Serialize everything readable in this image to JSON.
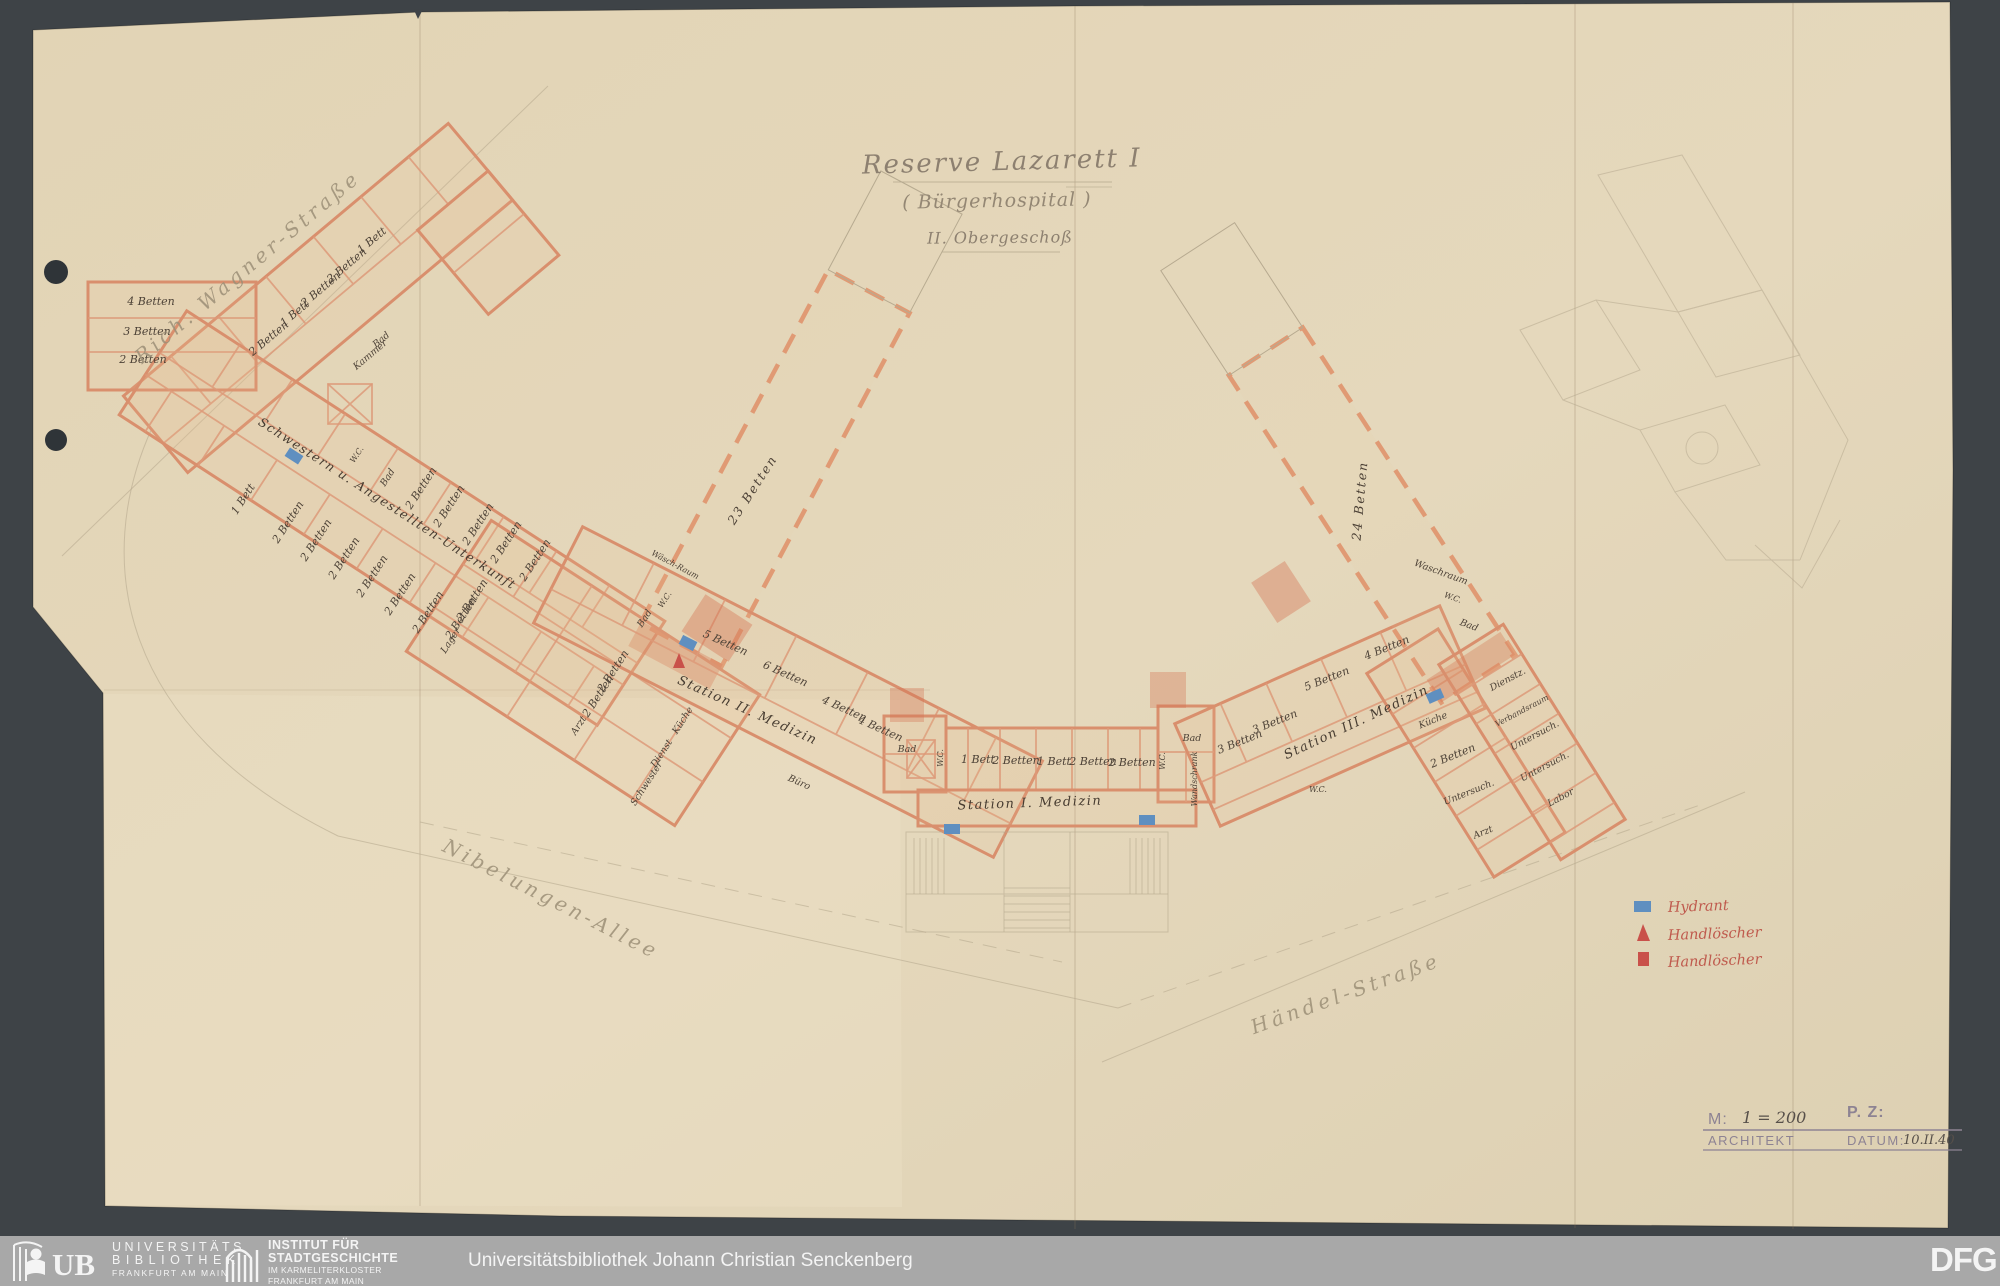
{
  "scan": {
    "title": {
      "line1": "Reserve Lazarett I",
      "line2": "( Bürgerhospital )",
      "line3": "II. Obergeschoß"
    },
    "streets": {
      "northwest": "Rich. Wagner-Straße",
      "southwest": "Nibelungen-Allee",
      "southeast": "Händel-Straße"
    },
    "plan": {
      "wing_nw": [
        "1 Bett",
        "2 Betten",
        "2 Betten",
        "1 Bett",
        "2 Betten",
        "Bad",
        "Kammer"
      ],
      "left_block": [
        "4 Betten",
        "3 Betten",
        "2 Betten"
      ],
      "staff_corridor": "Schwestern u. Angestellten-Unterkunft",
      "staff_upper": [
        "W.C.",
        "Bad",
        "2 Betten",
        "2 Betten",
        "2 Betten",
        "2 Betten",
        "2 Betten"
      ],
      "staff_lower": [
        "1 Bett",
        "2 Betten",
        "2 Betten",
        "2 Betten",
        "2 Betten",
        "2 Betten",
        "2 Betten"
      ],
      "hall_west": "23 Betten",
      "hall_west_rooms": [
        "Wäsch-Raum",
        "W.C.",
        "Bad"
      ],
      "mid_rooms": [
        "2 Betten",
        "2 Betten",
        "Arzt",
        "2 Betten",
        "2 Betten",
        "Lager",
        "Küche",
        "Dienst",
        "Schwester"
      ],
      "station2": {
        "corridor": "Station II. Medizin",
        "rooms": [
          "5 Betten",
          "6 Betten",
          "4 Betten",
          "4 Betten",
          "Büro"
        ]
      },
      "station1": {
        "corridor": "Station I. Medizin",
        "rooms": [
          "Bad",
          "W.C.",
          "1 Bett",
          "2 Betten",
          "1 Bett",
          "2 Betten",
          "2 Betten",
          "W.C.",
          "Bad",
          "Wandschrank"
        ]
      },
      "station3": {
        "corridor": "Station III. Medizin",
        "rooms": [
          "3 Betten",
          "3 Betten",
          "5 Betten",
          "4 Betten",
          "W.C.",
          "Küche",
          "2 Betten",
          "Untersuch.",
          "Arzt"
        ]
      },
      "hall_east": "24 Betten",
      "hall_east_rooms": [
        "Waschraum",
        "W.C.",
        "Bad"
      ],
      "east_rooms": [
        "Dienstz.",
        "Verbandsraum",
        "Untersuch.",
        "Untersuch.",
        "Labor"
      ]
    },
    "legend": [
      {
        "symbol": "hydrant-blue-rect",
        "label": "Hydrant"
      },
      {
        "symbol": "extinguisher-red-triangle",
        "label": "Handlöscher"
      },
      {
        "symbol": "extinguisher-red-square",
        "label": "Handlöscher"
      }
    ],
    "titleblock": {
      "scale_label": "M:",
      "scale_value": "1 = 200",
      "pz_label": "P. Z:",
      "architect_label": "ARCHITEKT",
      "date_label": "DATUM:",
      "date_value": "10.II.40"
    },
    "colors": {
      "paper": "#e3d6b8",
      "wall_salmon": "#d98f6d",
      "hydrant_blue": "#5f8fc0",
      "extinguisher_red": "#c9514a",
      "background": "#3e4347"
    }
  },
  "footer": {
    "ub_monogram": "UB",
    "ub_lines": [
      "UNIVERSITÄTS",
      "BIBLIOTHEK",
      "FRANKFURT AM MAIN"
    ],
    "isg_lines": [
      "INSTITUT FÜR",
      "STADTGESCHICHTE",
      "IM KARMELITERKLOSTER",
      "FRANKFURT AM MAIN"
    ],
    "center_text": "Universitätsbibliothek Johann Christian Senckenberg",
    "dfg_text": "DFG"
  }
}
